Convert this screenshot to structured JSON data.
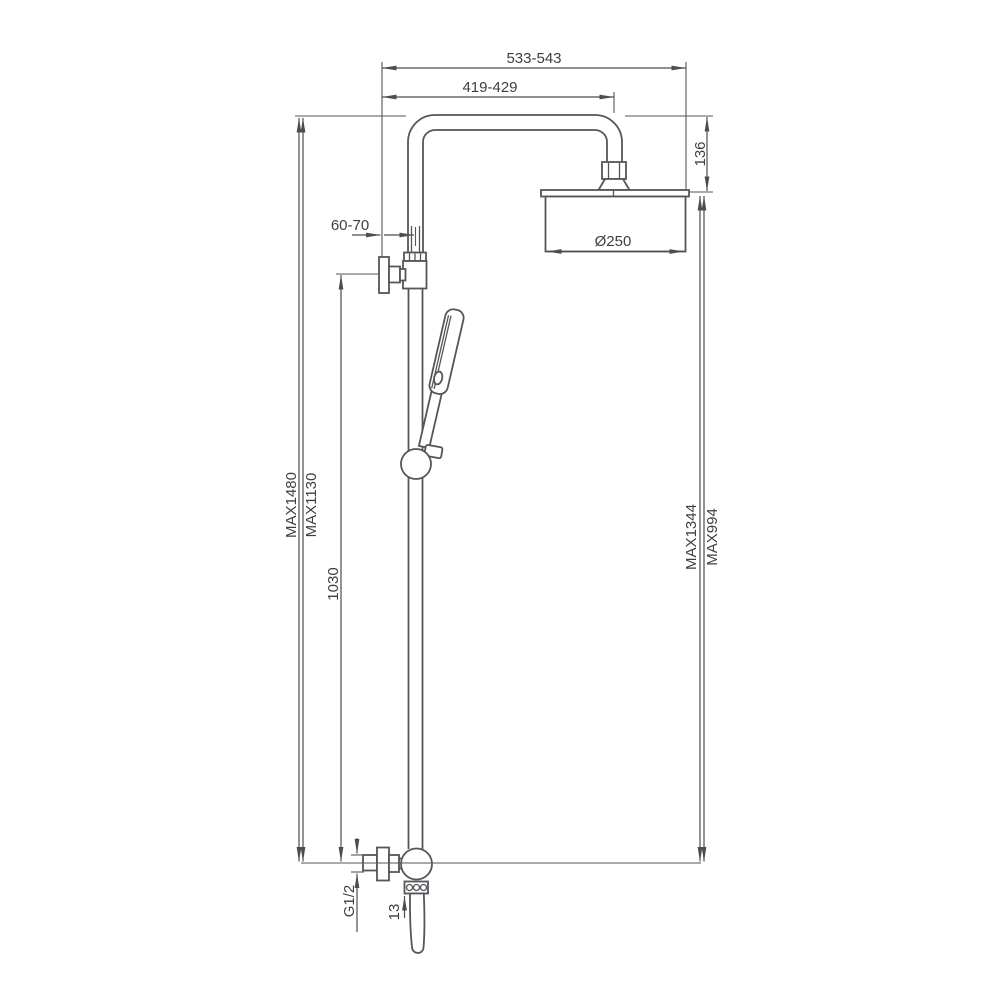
{
  "drawing": {
    "type": "technical-dimension-drawing",
    "subject": "wall-mounted shower column with overhead rain shower head, hand shower on sliding rail and bottom mixer valve",
    "background_color": "#ffffff",
    "line_color": "#55565a",
    "text_color": "#3e3f42"
  },
  "dimensions": {
    "overall_reach": "533-543",
    "arm_projection": "419-429",
    "head_drop_height": "136",
    "shower_head_diameter": "Ø250",
    "wall_to_riser": "60-70",
    "max_total_height": "MAX1480",
    "max_upper_height": "MAX1130",
    "bracket_to_valve": "1030",
    "max_head_height": "MAX1344",
    "max_outlet_height": "MAX994",
    "inlet_thread": "G1/2",
    "outlet_offset": "13"
  }
}
